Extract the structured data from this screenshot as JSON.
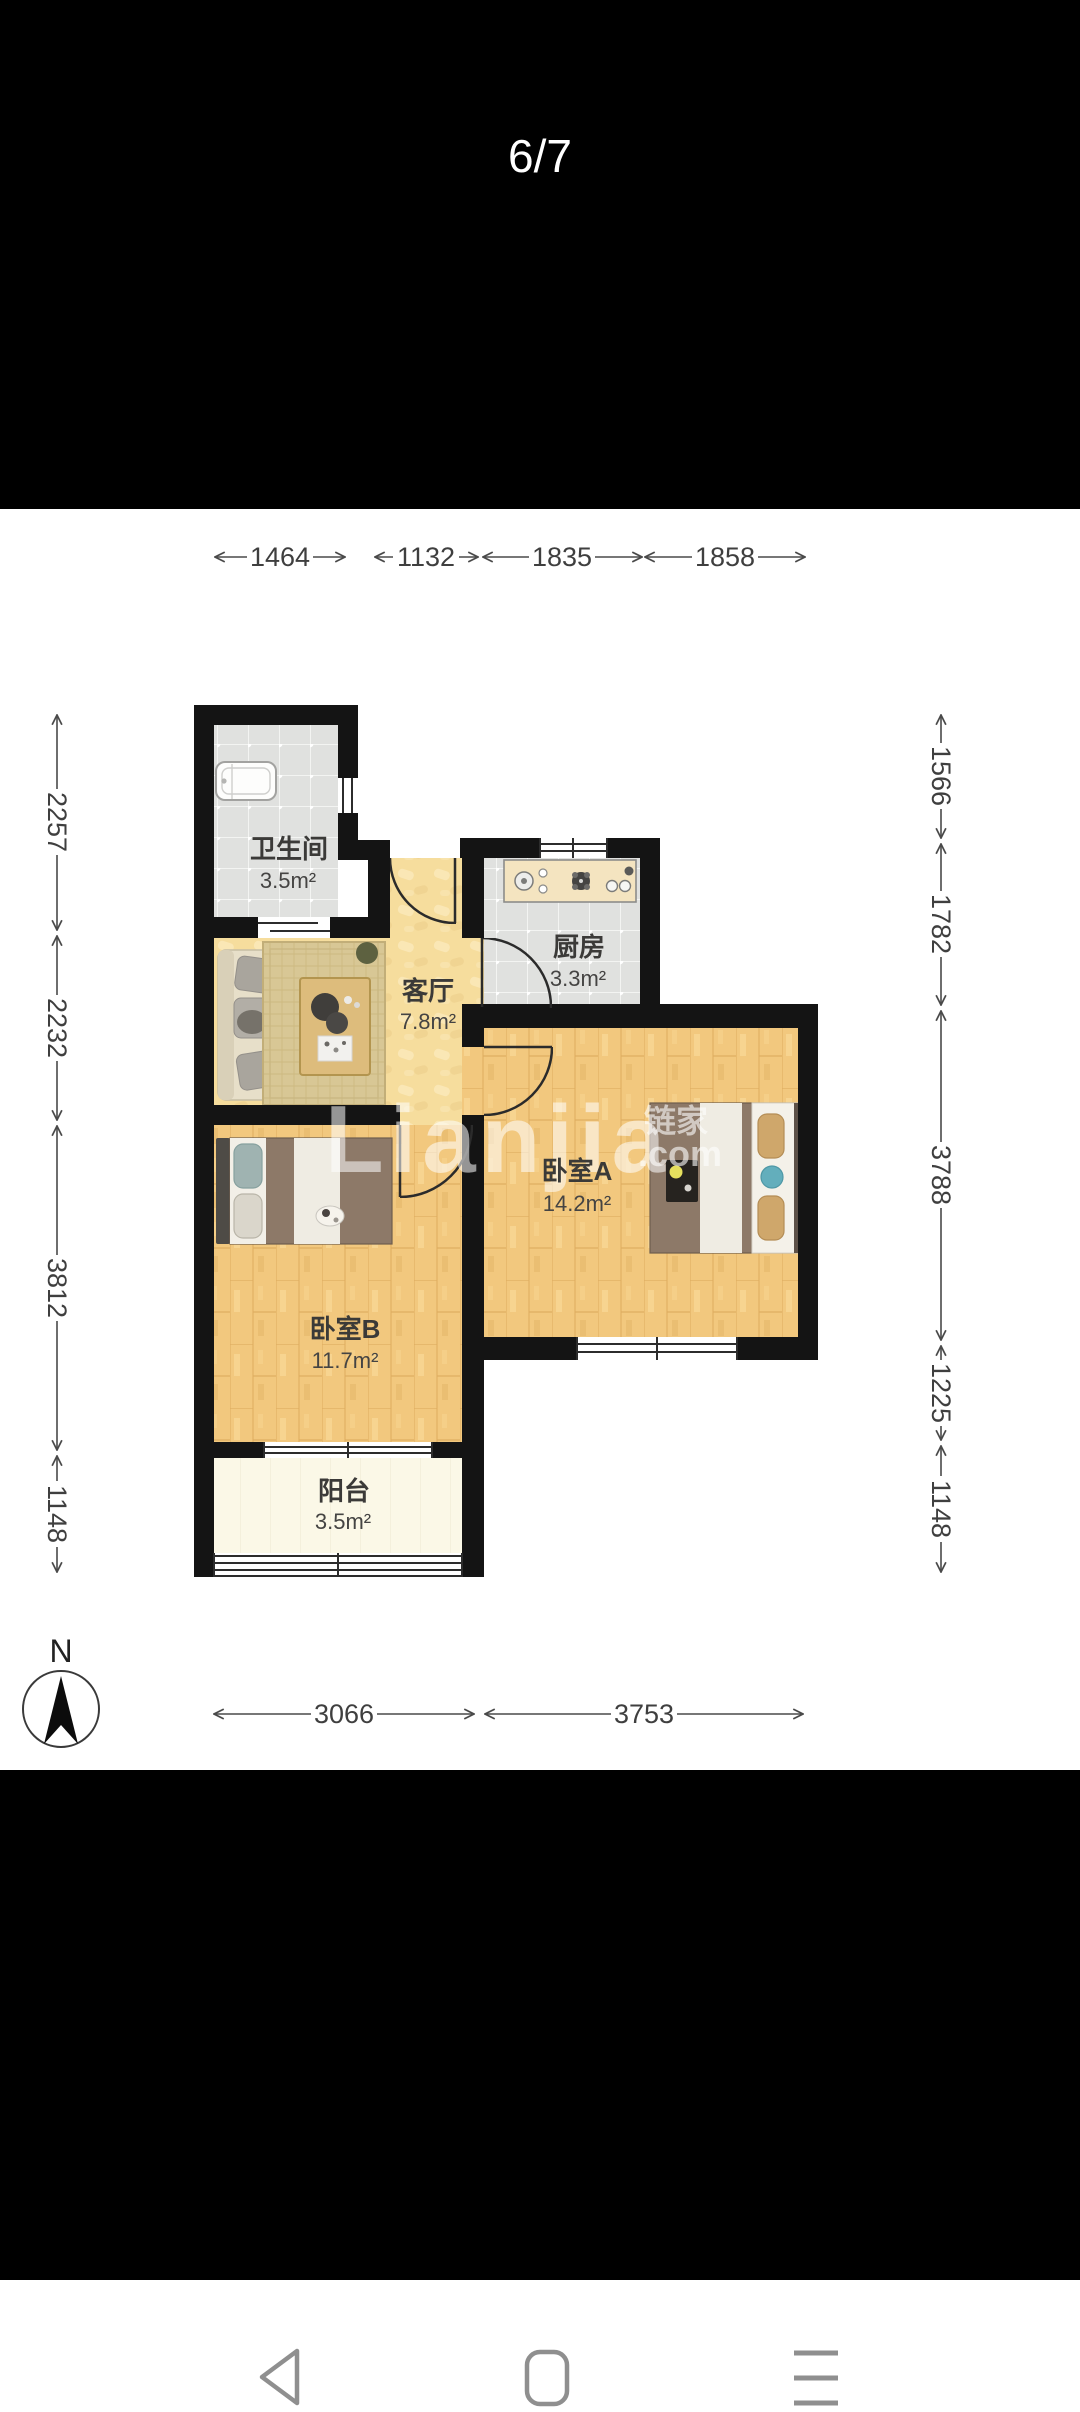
{
  "page_indicator": "6/7",
  "floorplan": {
    "rooms": [
      {
        "name": "卫生间",
        "area": "3.5m²"
      },
      {
        "name": "客厅",
        "area": "7.8m²"
      },
      {
        "name": "厨房",
        "area": "3.3m²"
      },
      {
        "name": "卧室A",
        "area": "14.2m²"
      },
      {
        "name": "卧室B",
        "area": "11.7m²"
      },
      {
        "name": "阳台",
        "area": "3.5m²"
      }
    ],
    "dimensions_mm": {
      "top": [
        "1464",
        "1132",
        "1835",
        "1858"
      ],
      "left": [
        "2257",
        "2232",
        "3812",
        "1148"
      ],
      "right": [
        "1566",
        "1782",
        "3788",
        "1225",
        "1148"
      ],
      "bottom": [
        "3066",
        "3753"
      ]
    },
    "compass_label": "N",
    "watermark": {
      "main": "Lianjia",
      "cn": "链家",
      "com": ".com"
    },
    "colors": {
      "wall": "#141414",
      "tile_floor": "#e0e1df",
      "living_floor": "#f6dd9d",
      "wood_floor": "#f2c87e",
      "balcony_floor": "#fbf8e7",
      "bed_blanket": "#8d7968",
      "accent_teal": "#63aebc"
    }
  },
  "navbar": {
    "icons": [
      "back",
      "home",
      "menu"
    ]
  }
}
